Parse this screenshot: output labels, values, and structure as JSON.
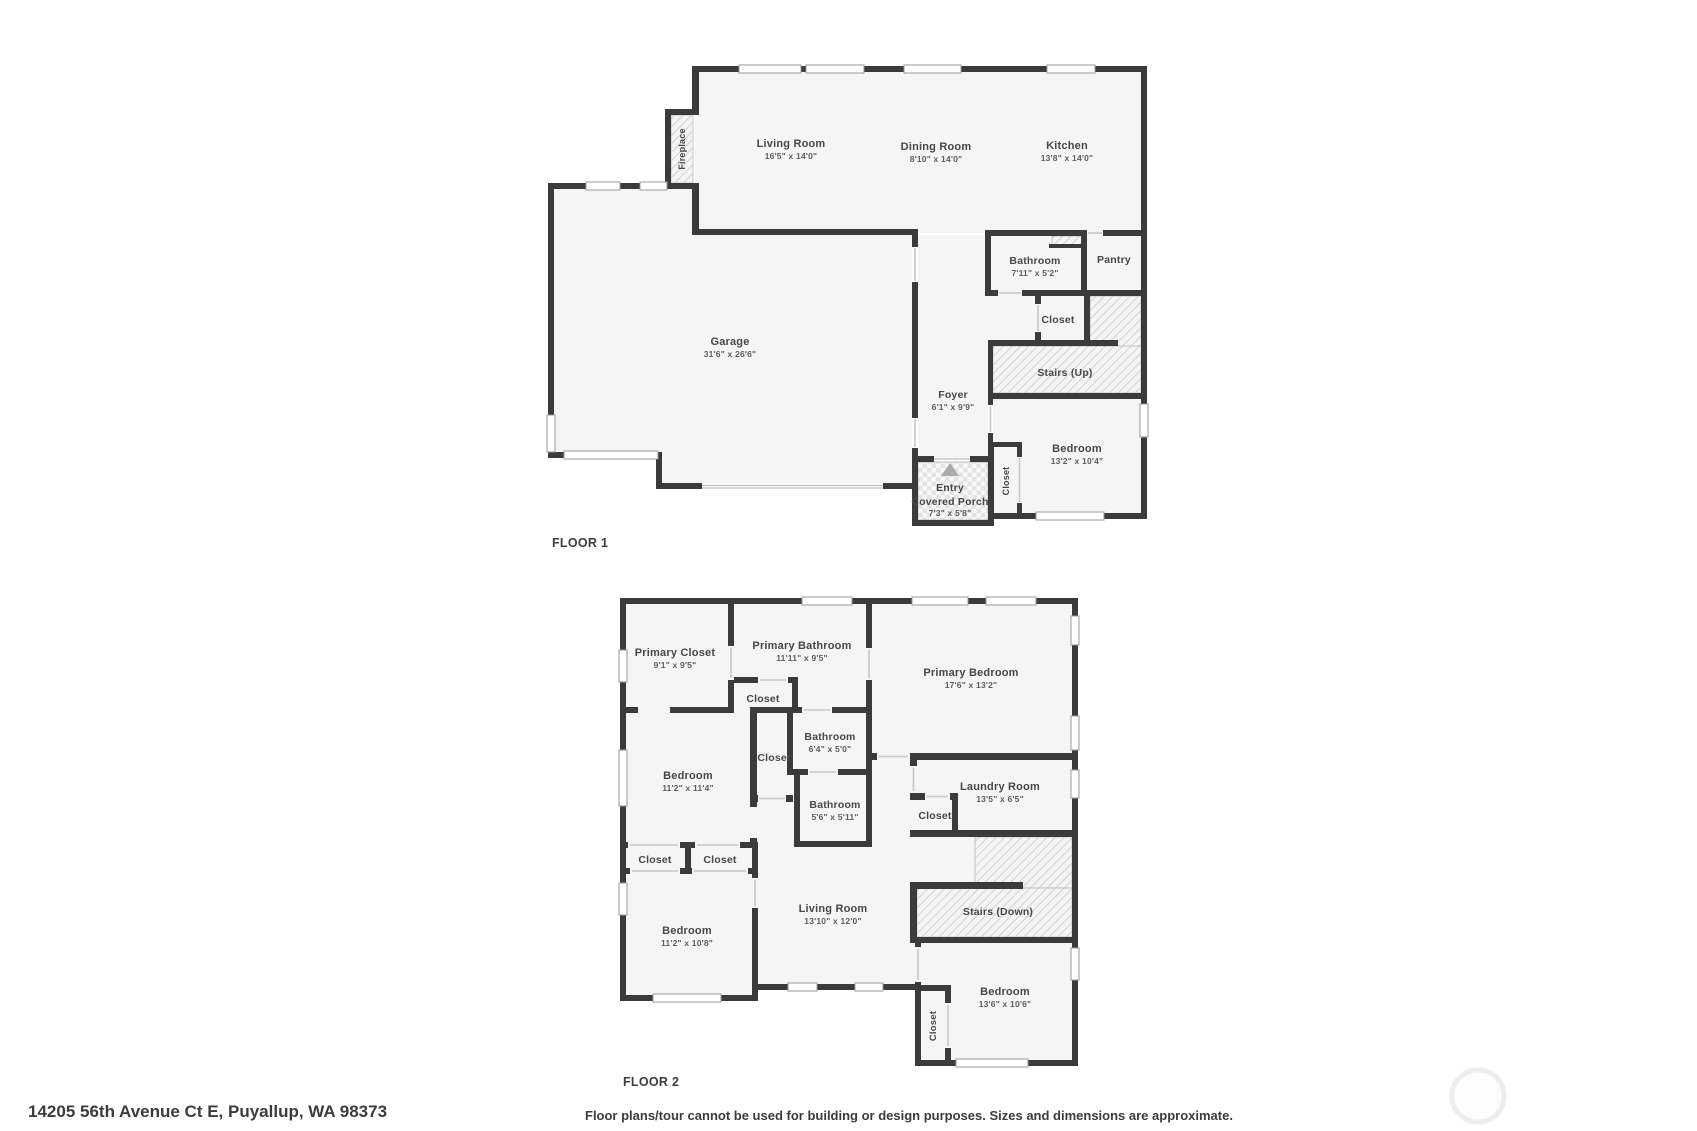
{
  "page": {
    "address": "14205 56th Avenue Ct E, Puyallup, WA 98373",
    "disclaimer": "Floor plans/tour cannot be used for building or design purposes. Sizes and dimensions are approximate.",
    "colors": {
      "wall": "#3b3b3b",
      "room_fill": "#f5f5f5",
      "text": "#474747"
    }
  },
  "floor1": {
    "label": "FLOOR 1",
    "rooms": {
      "living_room": {
        "name": "Living Room",
        "dims": "16'5\" x 14'0\""
      },
      "dining_room": {
        "name": "Dining Room",
        "dims": "8'10\" x 14'0\""
      },
      "kitchen": {
        "name": "Kitchen",
        "dims": "13'8\" x 14'0\""
      },
      "garage": {
        "name": "Garage",
        "dims": "31'6\" x 26'6\""
      },
      "bathroom": {
        "name": "Bathroom",
        "dims": "7'11\" x 5'2\""
      },
      "pantry": {
        "name": "Pantry"
      },
      "closet": {
        "name": "Closet"
      },
      "stairs_up": {
        "name": "Stairs (Up)"
      },
      "foyer": {
        "name": "Foyer",
        "dims": "6'1\" x 9'9\""
      },
      "bedroom": {
        "name": "Bedroom",
        "dims": "13'2\" x 10'4\""
      },
      "bedroom_closet": {
        "name": "Closet"
      },
      "fireplace": {
        "name": "Fireplace"
      },
      "entry": {
        "name": "Entry"
      },
      "covered_porch": {
        "name": "Covered Porch",
        "dims": "7'3\" x 5'8\""
      }
    }
  },
  "floor2": {
    "label": "FLOOR 2",
    "rooms": {
      "primary_closet": {
        "name": "Primary Closet",
        "dims": "9'1\" x 9'5\""
      },
      "primary_bathroom": {
        "name": "Primary Bathroom",
        "dims": "11'11\" x 9'5\""
      },
      "primary_bedroom": {
        "name": "Primary Bedroom",
        "dims": "17'6\" x 13'2\""
      },
      "closet_top": {
        "name": "Closet"
      },
      "bathroom_small": {
        "name": "Bathroom",
        "dims": "6'4\" x 5'0\""
      },
      "closet_hall": {
        "name": "Closet"
      },
      "bedroom_left_top": {
        "name": "Bedroom",
        "dims": "11'2\" x 11'4\""
      },
      "bathroom_mid": {
        "name": "Bathroom",
        "dims": "5'6\" x 5'11\""
      },
      "laundry": {
        "name": "Laundry Room",
        "dims": "13'5\" x 6'5\""
      },
      "laundry_closet": {
        "name": "Closet"
      },
      "closet_a": {
        "name": "Closet"
      },
      "closet_b": {
        "name": "Closet"
      },
      "bedroom_left_bottom": {
        "name": "Bedroom",
        "dims": "11'2\" x 10'8\""
      },
      "living_room": {
        "name": "Living Room",
        "dims": "13'10\" x 12'0\""
      },
      "stairs_down": {
        "name": "Stairs (Down)"
      },
      "bedroom_right": {
        "name": "Bedroom",
        "dims": "13'6\" x 10'6\""
      },
      "bedroom_right_closet": {
        "name": "Closet"
      }
    }
  }
}
